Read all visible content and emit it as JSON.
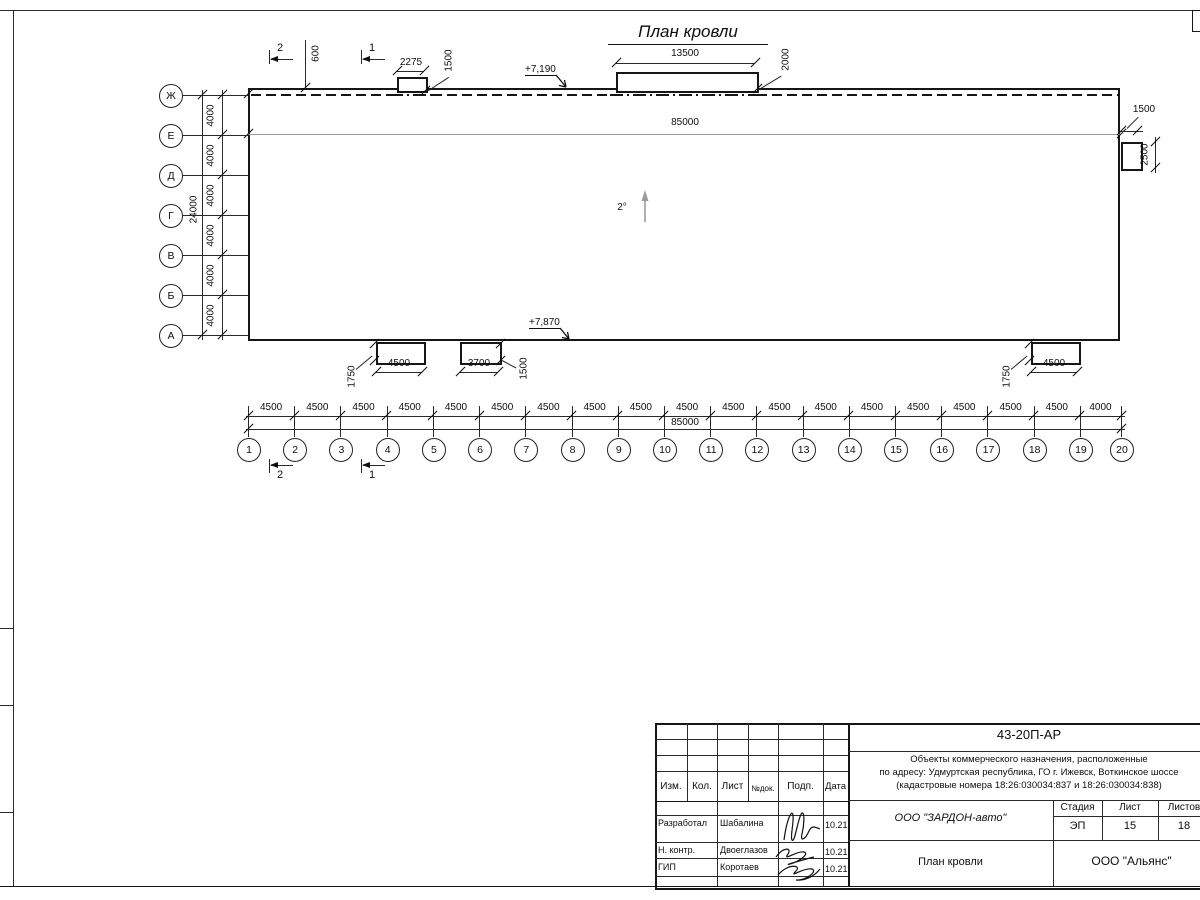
{
  "sheet": {
    "title": "План кровли"
  },
  "plan": {
    "slope_label": "2°",
    "elevation_top": "+7,190",
    "elevation_bottom": "+7,870",
    "total_length_top": "85000",
    "sections": {
      "s1": "1",
      "s2": "2"
    },
    "top_dims": {
      "d600": "600",
      "d2275": "2275",
      "d1500": "1500",
      "d13500": "13500",
      "d2000": "2000"
    },
    "right_dims": {
      "d1500": "1500",
      "d2500": "2500"
    },
    "bottom_dims": {
      "left_1750": "1750",
      "left_4500": "4500",
      "d3700": "3700",
      "d1500": "1500",
      "right_1750": "1750",
      "right_4500": "4500"
    }
  },
  "grid": {
    "columns": [
      "1",
      "2",
      "3",
      "4",
      "5",
      "6",
      "7",
      "8",
      "9",
      "10",
      "11",
      "12",
      "13",
      "14",
      "15",
      "16",
      "17",
      "18",
      "19",
      "20"
    ],
    "column_dims": [
      "4500",
      "4500",
      "4500",
      "4500",
      "4500",
      "4500",
      "4500",
      "4500",
      "4500",
      "4500",
      "4500",
      "4500",
      "4500",
      "4500",
      "4500",
      "4500",
      "4500",
      "4500",
      "4000"
    ],
    "columns_total": "85000",
    "rows": [
      "Ж",
      "Е",
      "Д",
      "Г",
      "В",
      "Б",
      "А"
    ],
    "row_dims": [
      "4000",
      "4000",
      "4000",
      "4000",
      "4000",
      "4000"
    ],
    "rows_total": "24000"
  },
  "title_block": {
    "doc_number": "43-20П-АР",
    "project_description": [
      "Объекты коммерческого назначения, расположенные",
      "по адресу: Удмуртская республика, ГО г. Ижевск, Воткинское шоссе",
      "(кадастровые номера 18:26:030034:837 и 18:26:030034:838)"
    ],
    "columns_header": [
      "Изм.",
      "Кол.",
      "Лист",
      "№док.",
      "Подп.",
      "Дата"
    ],
    "signers": [
      {
        "role": "Разработал",
        "name": "Шабалина",
        "date": "10.21"
      },
      {
        "role": "Н. контр.",
        "name": "Двоеглазов",
        "date": "10.21"
      },
      {
        "role": "ГИП",
        "name": "Коротаев",
        "date": "10.21"
      }
    ],
    "client": "ООО \"ЗАРДОН-авто\"",
    "stage_label": "Стадия",
    "sheet_label": "Лист",
    "sheets_label": "Листов",
    "stage": "ЭП",
    "sheet_number": "15",
    "sheets_total": "18",
    "drawing_title": "План кровли",
    "contractor": "ООО \"Альянс\""
  }
}
